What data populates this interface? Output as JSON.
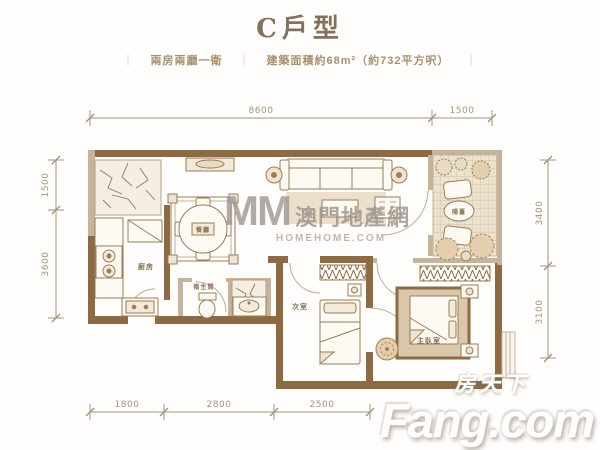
{
  "header": {
    "title": "C戶型",
    "separator": "｜",
    "specs": [
      "兩房兩廳一衛",
      "建築面積約68m²（約732平方呎）"
    ]
  },
  "dimensions": {
    "top": [
      "8600",
      "1500"
    ],
    "left": [
      "1500",
      "3600"
    ],
    "right": [
      "3400",
      "3100"
    ],
    "bottom": [
      "1800",
      "2800",
      "2500"
    ]
  },
  "rooms": {
    "kitchen": "廚房",
    "bathroom": "衛生間",
    "dining": "餐廳",
    "second_bedroom": "次室",
    "master_bedroom": "主臥室",
    "balcony": "陽臺"
  },
  "watermarks": {
    "center_logo": "MM",
    "center_text": "澳門地產網",
    "center_sub": "HOMEHOME.COM",
    "corner_cn": "房天下",
    "corner_en": "Fang.com"
  },
  "colors": {
    "wall_brown": "#8d6a42",
    "wall_tan": "#c6b49a",
    "dim_text": "#a4947a",
    "title_text": "#85715a"
  }
}
